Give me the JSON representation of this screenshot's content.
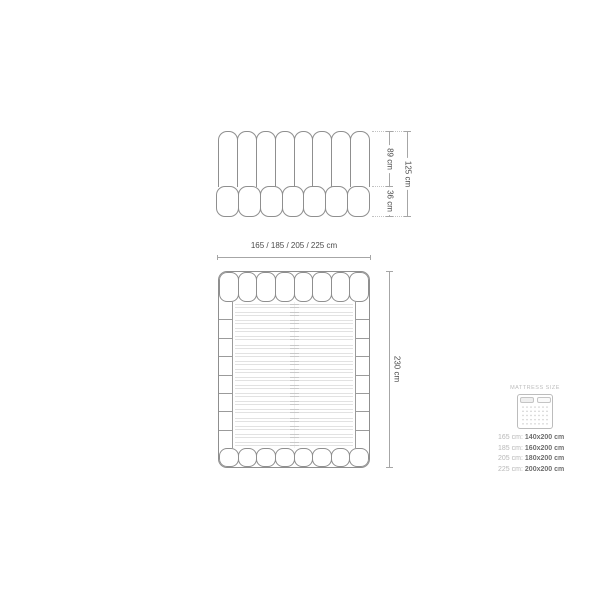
{
  "front_view": {
    "height_upper_label": "89 cm",
    "height_lower_label": "36 cm",
    "height_total_label": "125 cm"
  },
  "top_view": {
    "width_label": "165 / 185 / 205 / 225 cm",
    "length_label": "230 cm"
  },
  "legend": {
    "title": "MATTRESS SIZE",
    "rows": [
      {
        "bed": "165 cm:",
        "mattress": "140x200 cm"
      },
      {
        "bed": "185 cm:",
        "mattress": "160x200 cm"
      },
      {
        "bed": "205 cm:",
        "mattress": "180x200 cm"
      },
      {
        "bed": "225 cm:",
        "mattress": "200x200 cm"
      }
    ]
  },
  "diagram": {
    "front_headboard_channels": 8,
    "front_base_segments": 7,
    "top_headboard_tabs": 8,
    "top_footboard_tabs": 8,
    "side_rail_segments": 8,
    "slat_count": 18
  },
  "colors": {
    "outline": "#8f8f8f",
    "slat": "#e2e2e2",
    "dimension_line": "#a6a6a6",
    "dimension_text": "#4a4a4a",
    "legend_muted": "#b8b8b8",
    "legend_value": "#6e6e6e"
  }
}
